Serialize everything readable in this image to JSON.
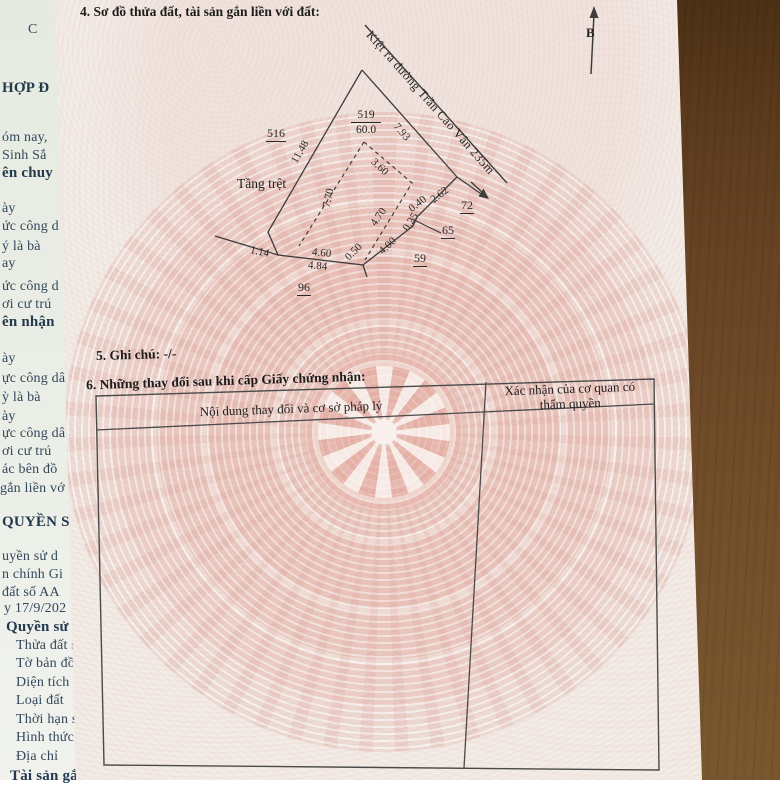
{
  "colors": {
    "wood_table": "#6b4826",
    "certificate_paper": "#f2ebe6",
    "drum_watermark_salmon": "#dfa89e",
    "underlying_paper": "#eaeee6",
    "ink": "#1c1c1c",
    "underlying_ink": "#32475b"
  },
  "certificate": {
    "section4_title": "4. Sơ đồ thửa đất, tài sản gắn liền với đất:",
    "section5_note": "5. Ghi chú: -/-",
    "section6_title": "6. Những thay đổi sau khi cấp Giấy chứng nhận:",
    "table": {
      "col1_header": "Nội dung thay đổi và cơ sở pháp lý",
      "col2_header": "Xác nhận của cơ quan có thẩm quyền"
    },
    "diagram": {
      "north_label": "B",
      "alley_label": "Kiệt ra đường Trần Cao Vân 235m",
      "parcel_number": "519",
      "parcel_area": "60.0",
      "ground_floor_label": "Tầng trệt",
      "adjacent_parcels": [
        "516",
        "72",
        "65",
        "59",
        "96"
      ],
      "dimensions": [
        "11.48",
        "7.93",
        "3.60",
        "7.70",
        "4.70",
        "2.62",
        "0.40",
        "0.25",
        "4.00",
        "0.50",
        "4.60",
        "4.84",
        "1.14"
      ]
    }
  },
  "underlying_page": {
    "fragments": [
      "C",
      "HỢP Đ",
      "óm nay,",
      "Sinh Sắ",
      "ên chuy",
      "ày",
      "ức công d",
      "ý là bà",
      "ay",
      "ức công d",
      "ơi cư trú",
      "ên nhận",
      "ày",
      "ực công dâ",
      "ỳ là bà",
      "ày",
      "ực công dâ",
      "ơi cư trú",
      "ác bên đồ",
      "gắn liền vớ",
      "QUYỀN S",
      "uyền sử d",
      "n chính Gi",
      "đất số AA",
      "y 17/9/202",
      "Quyền sử",
      "Thửa đất s",
      "Tờ bản đồ",
      "Diện tích",
      "Loại đất",
      "Thời hạn s",
      "Hình thức",
      "Địa chỉ",
      "Tài sản gắ"
    ]
  }
}
